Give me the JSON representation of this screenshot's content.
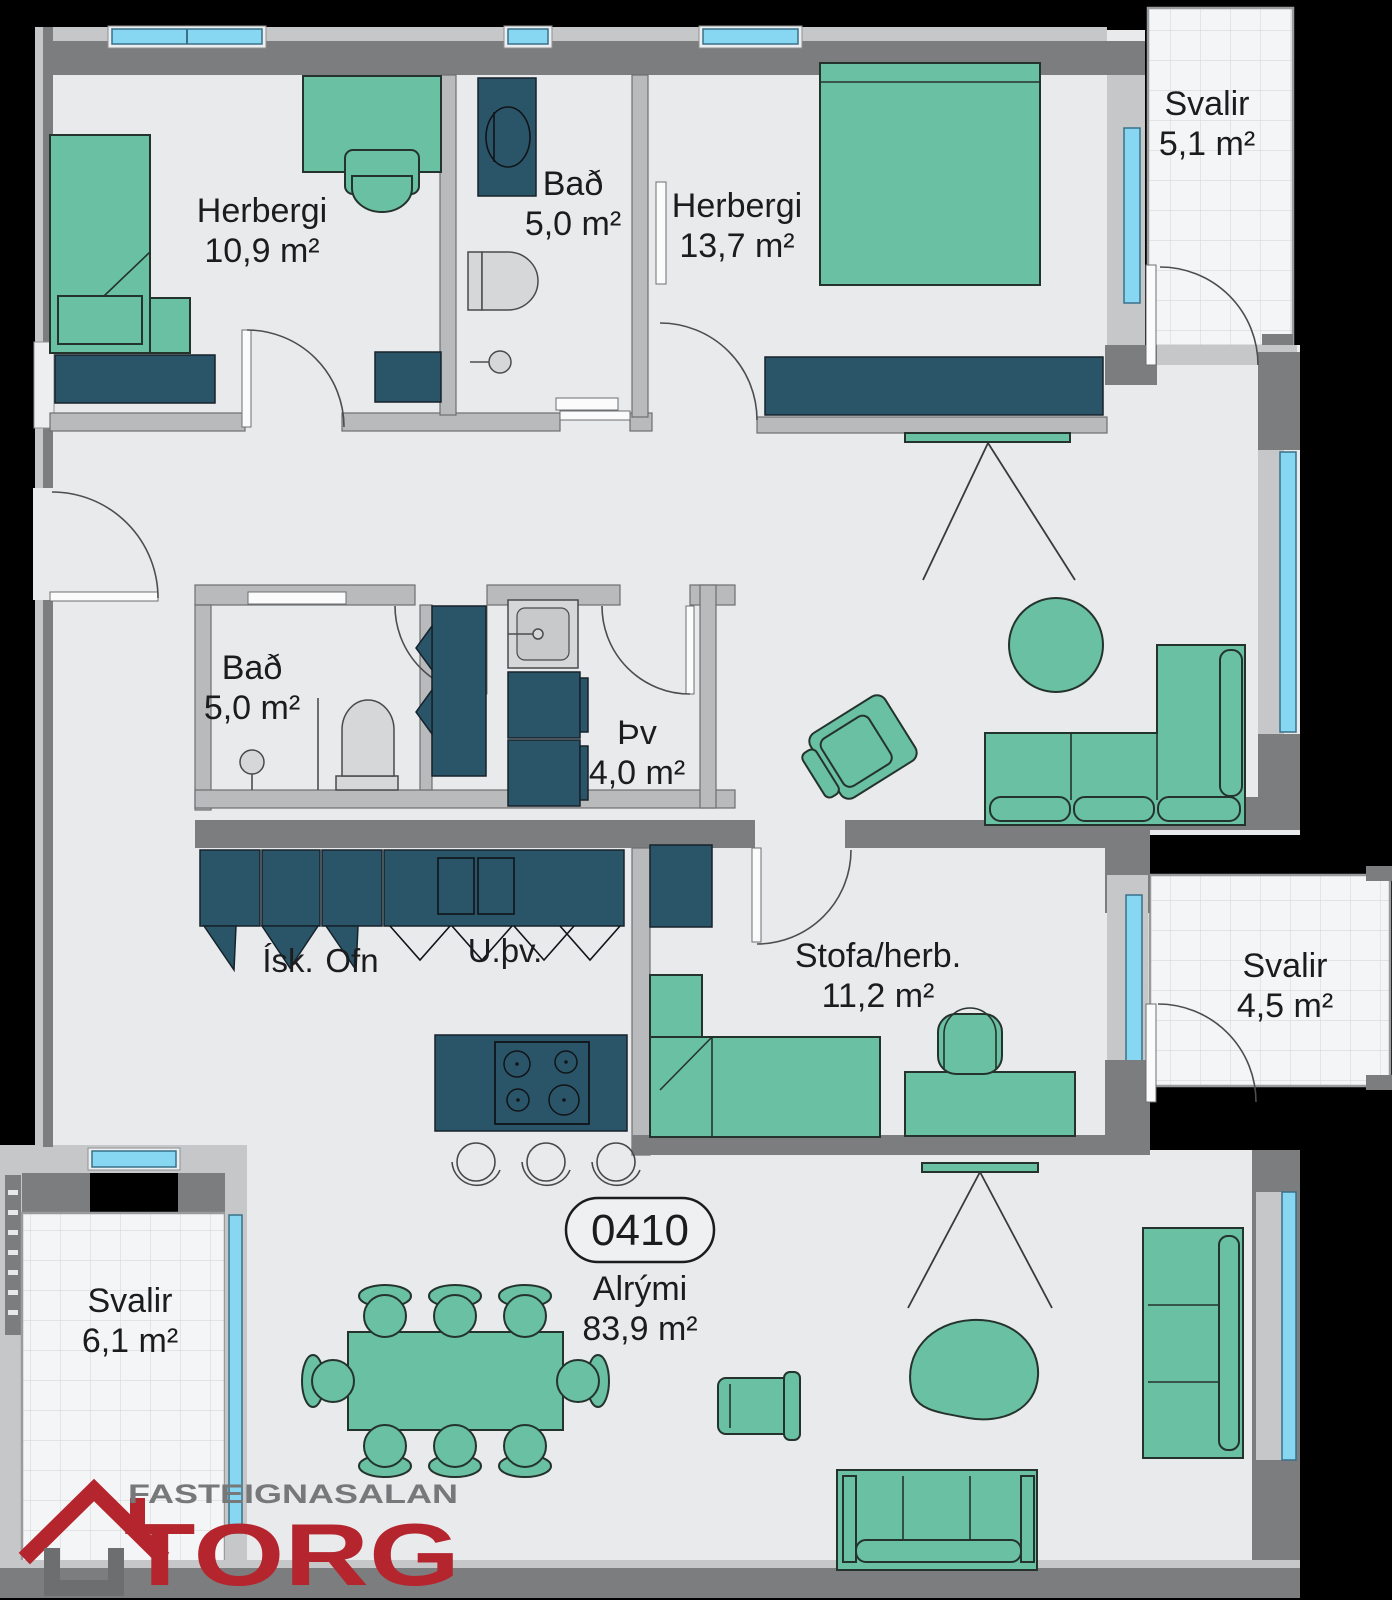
{
  "unit": {
    "number": "0410",
    "area_name": "Alrými",
    "area_value": "83,9 m²"
  },
  "rooms": [
    {
      "id": "herbergi-1",
      "name": "Herbergi",
      "area": "10,9 m²"
    },
    {
      "id": "bad-1",
      "name": "Bað",
      "area": "5,0 m²"
    },
    {
      "id": "herbergi-2",
      "name": "Herbergi",
      "area": "13,7 m²"
    },
    {
      "id": "svalir-1",
      "name": "Svalir",
      "area": "5,1 m²"
    },
    {
      "id": "bad-2",
      "name": "Bað",
      "area": "5,0 m²"
    },
    {
      "id": "thvottahus",
      "name": "Þv",
      "area": "4,0 m²"
    },
    {
      "id": "stofa-herb",
      "name": "Stofa/herb.",
      "area": "11,2 m²"
    },
    {
      "id": "svalir-2",
      "name": "Svalir",
      "area": "4,5 m²"
    },
    {
      "id": "svalir-3",
      "name": "Svalir",
      "area": "6,1 m²"
    }
  ],
  "kitchen_labels": {
    "fridge": "Ísk.",
    "oven": "Ofn",
    "dishwasher": "U.þv."
  },
  "logo": {
    "top": "FASTEIGNASALAN",
    "name": "TORG"
  },
  "colors": {
    "background": "#000000",
    "floor": "#e8eaec",
    "wall_dark": "#7c7d7f",
    "wall_light": "#c6c7c9",
    "furniture_green": "#69c0a3",
    "cabinet_teal": "#2a5568",
    "window_blue": "#87d7f3",
    "balcony_tile": "#f4f5f6",
    "logo_red": "#b5252e",
    "logo_gray": "#77787a"
  }
}
